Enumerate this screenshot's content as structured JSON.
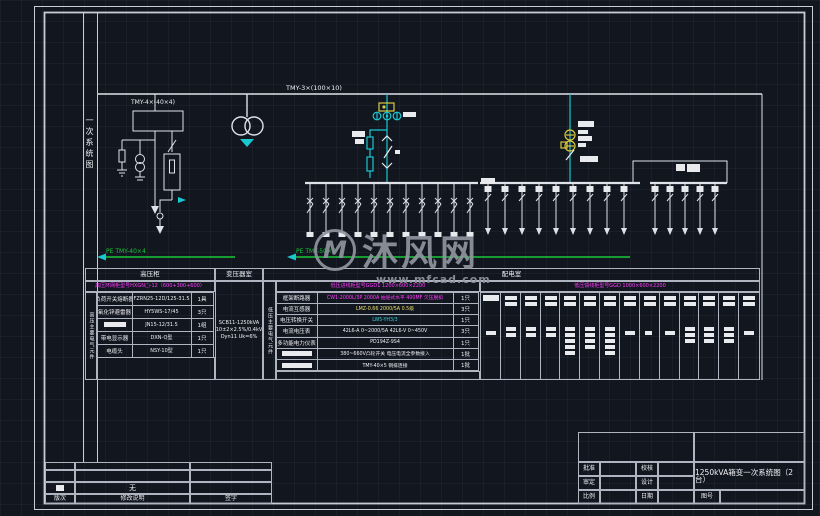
{
  "colors": {
    "background": "#12161f",
    "line_white": "#dfe3e9",
    "cyan": "#1ac8d2",
    "yellow": "#d9c93e",
    "magenta": "#ff3dff",
    "green": "#18c838",
    "watermark_gray": "#8f949e"
  },
  "watermark": {
    "logo_text": "M",
    "brand": "沐风网",
    "url": "www.mfcad.com"
  },
  "margin_label": "一次系统图",
  "diagram": {
    "hv_bus_label": "TMY-4×(40×4)",
    "main_bus_label": "TMY-3×(100×10)",
    "pe_left_label": "PE TMY-40×4",
    "pe_right_label": "PE TMY-50×5"
  },
  "rooms": {
    "hv": "高压柜",
    "transformer": "变压器室",
    "distribution": "配电室"
  },
  "hv_table": {
    "side_label": "高压主要电气元件",
    "model_row": "高压环网柜型号HXGN□-12（600+300+600）",
    "rows": [
      {
        "name": "负荷开关熔断器",
        "spec": "FZRN25-12D/125-31.5",
        "qty": "1具"
      },
      {
        "name": "氧化锌避雷器",
        "spec": "HY5WS-17/45",
        "qty": "3只"
      },
      {
        "name": "",
        "spec": "JN15-12/31.5",
        "qty": "1组"
      },
      {
        "name": "带电显示器",
        "spec": "DXN-Q型",
        "qty": "1只"
      },
      {
        "name": "电缆头",
        "spec": "NSY-10型",
        "qty": "1只"
      }
    ]
  },
  "transformer_room": {
    "lines": [
      "SCB11-1250kVA",
      "10±2×2.5%/0.4kV",
      "Dyn11  Uk=6%"
    ]
  },
  "lv_table": {
    "side_label": "低压主要电气元件",
    "model_row": "低压进线柜型号GGD1  1200×600×2200",
    "rows": [
      {
        "name": "框架断路器",
        "spec": "CW1-2000L/3P 2000A 抽屉式水平 400MF 欠压脱扣",
        "qty": "1只"
      },
      {
        "name": "电流互感器",
        "spec": "LMZ-0.66 2000/5A 0.5级",
        "qty": "3只"
      },
      {
        "name": "电压转换开关",
        "spec": "LW5-YH3/3",
        "qty": "1只"
      },
      {
        "name": "电流电压表",
        "spec": "42L6-A 0~2000/5A  42L6-V 0~450V",
        "qty": "3只"
      },
      {
        "name": "多功能电力仪表",
        "spec": "PD194Z-9S4",
        "qty": "1只"
      },
      {
        "name": "",
        "spec": "380~660V凸轮开关 电压电流全参数接入",
        "qty": "1批"
      },
      {
        "name": "",
        "spec": "TMY-40×5 铜排连接",
        "qty": "1批"
      }
    ]
  },
  "feeder_table": {
    "model_row": "低压馈线柜型号GGD  1000×600×2200"
  },
  "revision": {
    "none_text": "无",
    "headers": [
      "版次",
      "修改说明",
      "签字"
    ]
  },
  "title_block": {
    "approve": "批准",
    "review": "审定",
    "scale": "比例",
    "check": "校核",
    "design": "设计",
    "date": "日期",
    "drawing_no": "图号",
    "title": "1250kVA箱变一次系统图（2台）"
  }
}
